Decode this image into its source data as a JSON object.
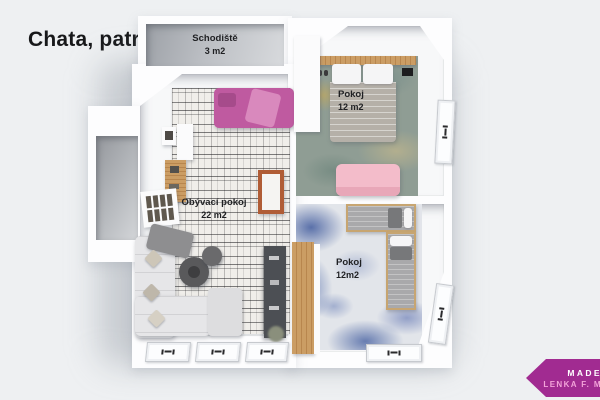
{
  "title": "Chata, patro",
  "plan": {
    "rooms": [
      {
        "name": "Schodiště",
        "area": "3 m2"
      },
      {
        "name": "Pokoj",
        "area": "12 m2"
      },
      {
        "name": "Obývací pokoj",
        "area": "22 m2"
      },
      {
        "name": "Pokoj",
        "area": "12m2"
      }
    ]
  },
  "watermark": {
    "line1": "MADE",
    "line2": "LENKA F. M"
  },
  "colors": {
    "background": "#eef0f2",
    "ribbon": "#a12b91",
    "ribbon_text": "#ffffff",
    "ribbon_subtext": "#f2a3d9",
    "daybed_pink": "#bf5aa0",
    "loveseat_pink": "#f3bcca",
    "wood": "#c79a62",
    "fireplace_orange": "#b05c35",
    "rug_teal_base": "#8f9d94",
    "rug_blue_accent": "#5f76ad",
    "tv_unit_gray": "#4c4f54",
    "stair_floor_gray": "#bcbfc4"
  }
}
